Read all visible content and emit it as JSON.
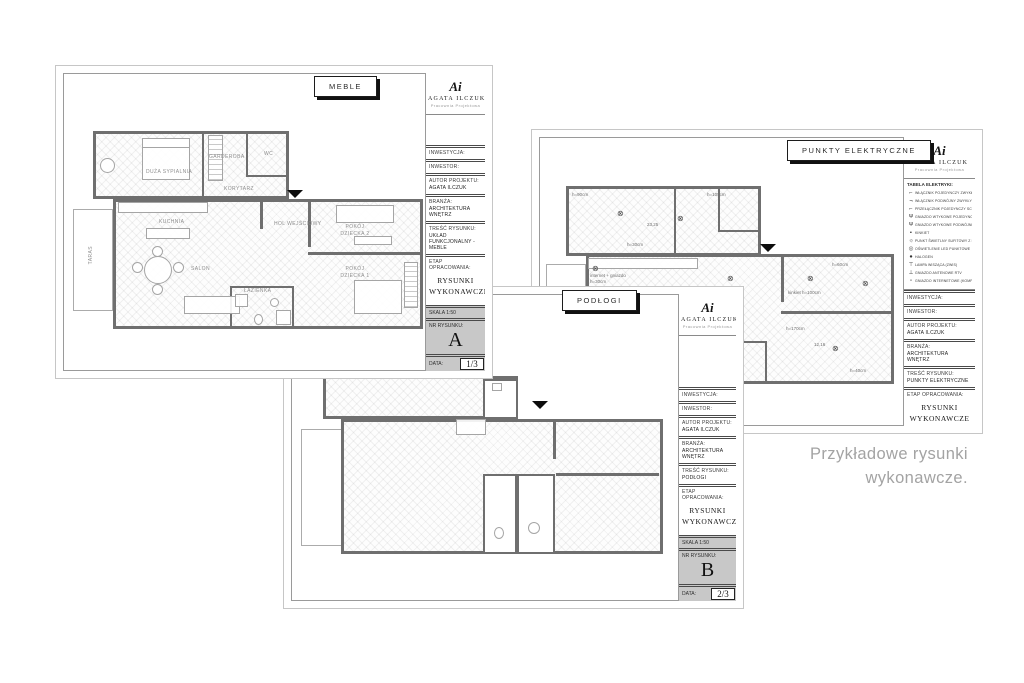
{
  "caption": {
    "line1": "Przykładowe rysunki",
    "line2": "wykonawcze."
  },
  "brand": {
    "monogram": "Ai",
    "name": "AGATA ILCZUK",
    "tagline": "Pracownia Projektowa"
  },
  "titleblock": {
    "inwestycja": "INWESTYCJA:",
    "inwestor": "INWESTOR:",
    "autor_label": "AUTOR PROJEKTU:",
    "autor_value": "AGATA ILCZUK",
    "branza_label": "BRANŻA:",
    "branza_value": "ARCHITEKTURA WNĘTRZ",
    "tresc_label": "TREŚĆ RYSUNKU:",
    "etap_label": "ETAP OPRACOWANIA:",
    "etap_value": "RYSUNKI WYKONAWCZE",
    "skala": "SKALA 1:50",
    "nr_label": "NR RYSUNKU:",
    "data_label": "DATA:"
  },
  "sheets": {
    "a": {
      "tab": "MEBLE",
      "tresc_value": "UKŁAD FUNKCJONALNY - MEBLE",
      "number": "A",
      "page": "1/3",
      "rooms": {
        "sypialnia": "DUŻA SYPIALNIA",
        "garderoba": "GARDEROBA",
        "wc": "WC",
        "korytarz": "KORYTARZ",
        "kuchnia": "KUCHNIA",
        "hol": "HOL WEJŚCIOWY",
        "salon": "SALON",
        "dziecko2": "POKÓJ DZIECKA 2",
        "dziecko1": "POKÓJ DZIECKA 1",
        "lazienka": "ŁAZIENKA",
        "taras": "TARAS"
      }
    },
    "b": {
      "tab": "PODŁOGI",
      "tresc_value": "PODŁOGI",
      "number": "B",
      "page": "2/3"
    },
    "c": {
      "tab": "PUNKTY ELEKTRYCZNE",
      "tresc_value": "PUNKTY ELEKTRYCZNE",
      "number": "C",
      "page": "3/3",
      "legend_title": "TABELA ELEKTRYKI:",
      "legend": [
        {
          "icon_name": "single-switch-icon",
          "glyph": "⌐",
          "label": "WŁĄCZNIK POJEDYNCZY ZWYKŁY"
        },
        {
          "icon_name": "double-switch-icon",
          "glyph": "¬",
          "label": "WŁĄCZNIK PODWÓJNY ZWYKŁY"
        },
        {
          "icon_name": "stair-switch-icon",
          "glyph": "⌐",
          "label": "PRZEŁĄCZNIK POJEDYNCZY SCHODOWY"
        },
        {
          "icon_name": "socket-single-icon",
          "glyph": "Ψ",
          "label": "GNIAZDO WTYKOWE POJEDYNCZE"
        },
        {
          "icon_name": "socket-double-icon",
          "glyph": "Ψ",
          "label": "GNIAZDO WTYKOWE PODWÓJNE"
        },
        {
          "icon_name": "wall-lamp-icon",
          "glyph": "▪",
          "label": "KINKIET"
        },
        {
          "icon_name": "ceiling-light-icon",
          "glyph": "☼",
          "label": "PUNKT ŚWIETLNY SUFITOWY Z LAMPĄ"
        },
        {
          "icon_name": "led-spot-icon",
          "glyph": "◎",
          "label": "OŚWIETLENIE LED PUNKTOWE"
        },
        {
          "icon_name": "halogen-icon",
          "glyph": "●",
          "label": "HALOGEN"
        },
        {
          "icon_name": "pendant-lamp-icon",
          "glyph": "⊤",
          "label": "LAMPA WISZĄCA (ZWIS)"
        },
        {
          "icon_name": "rtv-socket-icon",
          "glyph": "⊥",
          "label": "GNIAZDO ANTENOWE RTV"
        },
        {
          "icon_name": "internet-socket-icon",
          "glyph": "▫",
          "label": "GNIAZDO INTERNETOWE (KOMPUTEROWE)"
        }
      ],
      "annotations": [
        "h=90cm",
        "h=30cm",
        "internet + gniazdo h=30cm",
        "h=105cm",
        "h=170cm",
        "kinkiet h=100cm",
        "h=40cm",
        "h=60cm",
        "23,25",
        "12,16"
      ]
    }
  }
}
